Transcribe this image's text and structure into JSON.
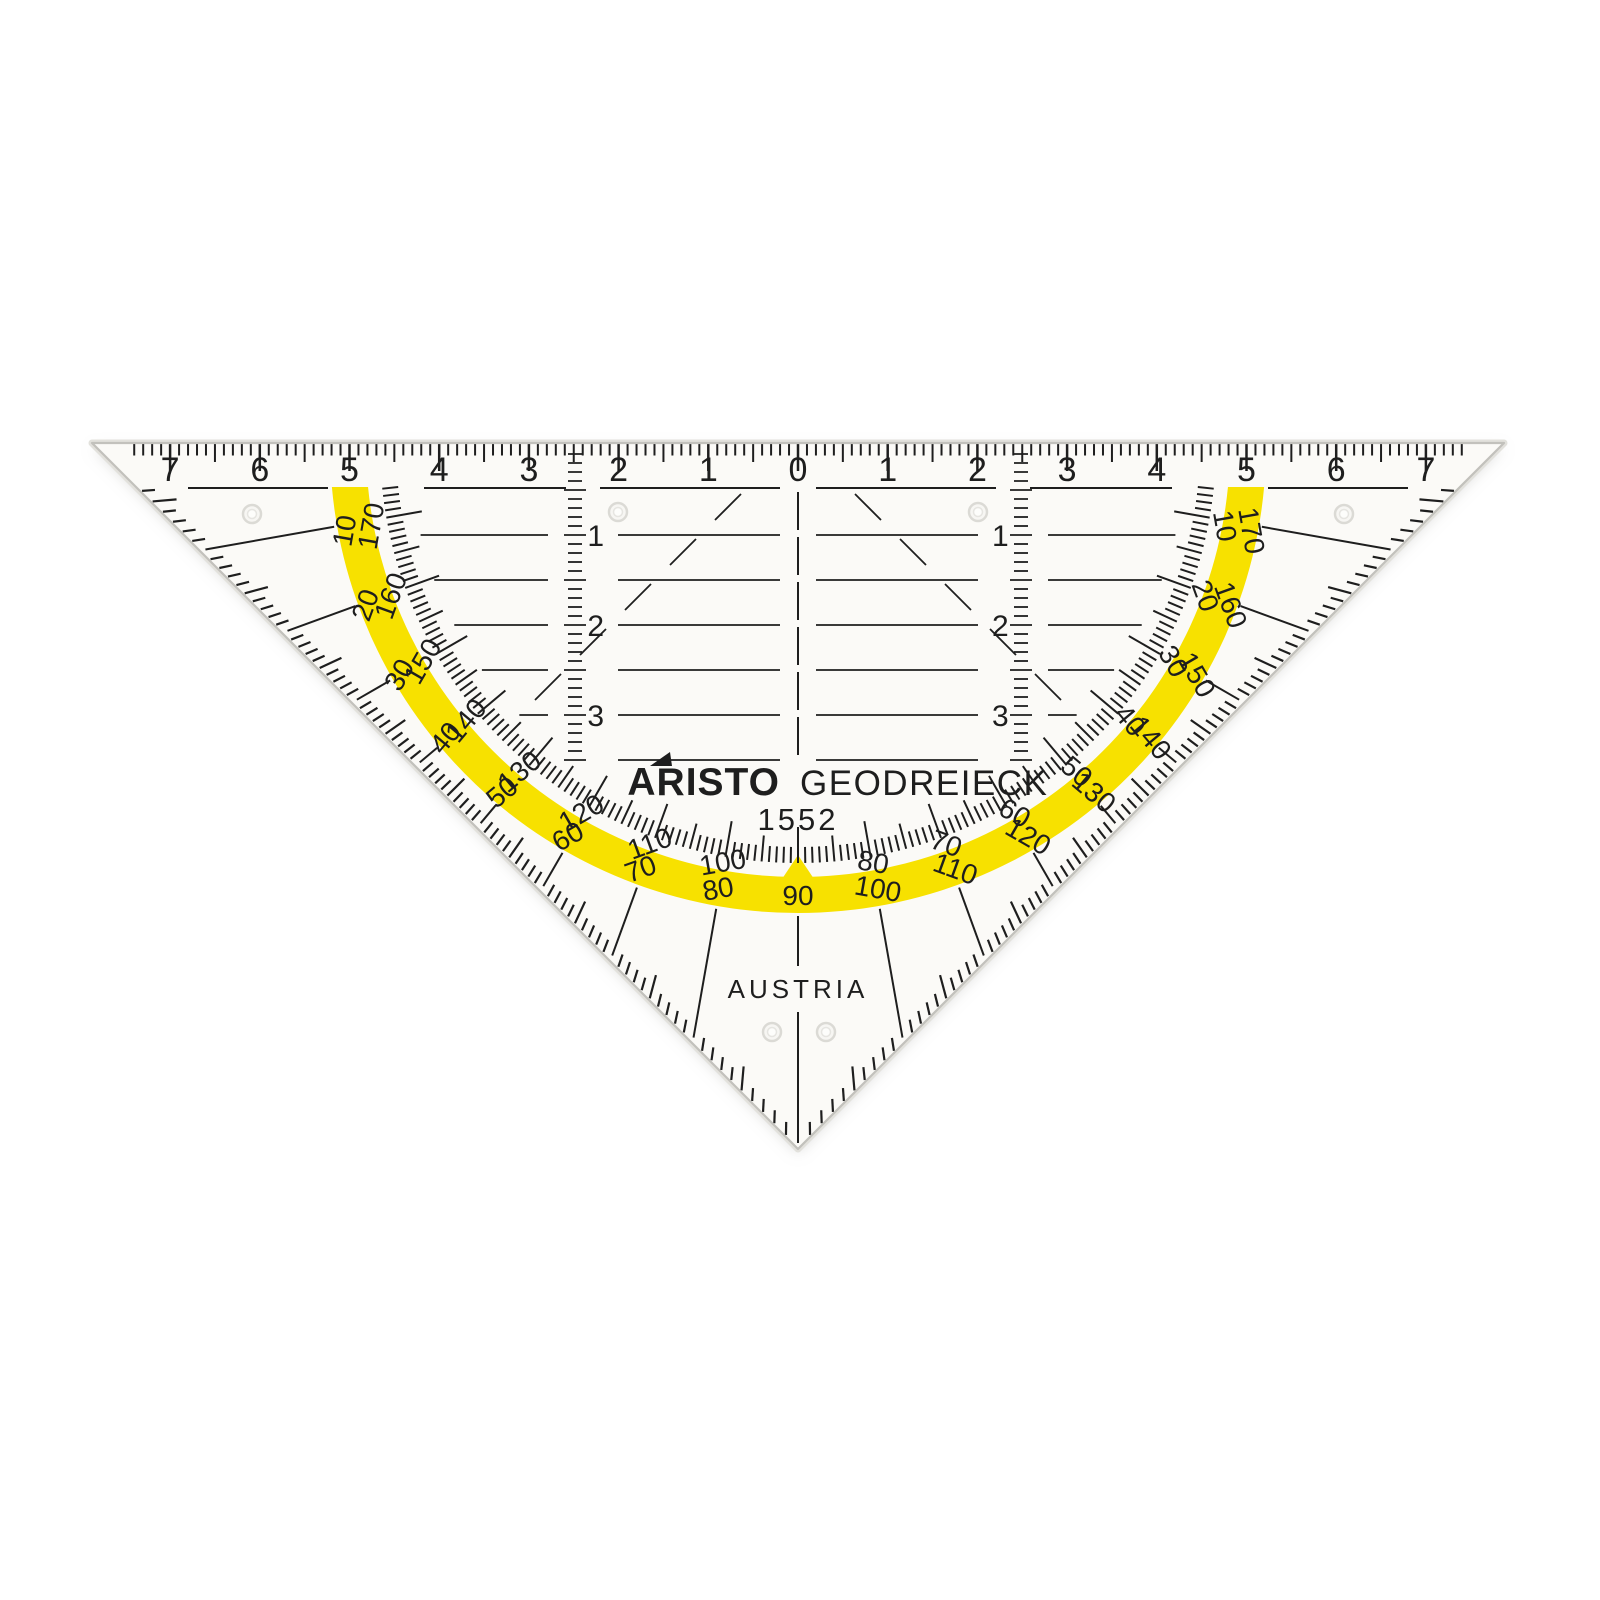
{
  "product": {
    "brand": "ARISTO",
    "name": "GEODREIECK",
    "model": "1552",
    "origin": "AUSTRIA"
  },
  "ruler": {
    "left_labels": [
      "7",
      "6",
      "5",
      "4",
      "3",
      "2",
      "1"
    ],
    "zero_label": "0",
    "right_labels": [
      "1",
      "2",
      "3",
      "4",
      "5",
      "6",
      "7"
    ]
  },
  "parallel_guides": {
    "labels": [
      "1",
      "2",
      "3"
    ]
  },
  "protractor": {
    "band_scale_deg": [
      "10",
      "20",
      "30",
      "40",
      "50",
      "60",
      "70",
      "80",
      "90",
      "100",
      "110",
      "120",
      "130",
      "140",
      "150",
      "160",
      "170"
    ],
    "inner_scale_deg": [
      "170",
      "160",
      "150",
      "140",
      "130",
      "120",
      "110",
      "100",
      "80",
      "70",
      "60",
      "50",
      "40",
      "30",
      "20",
      "10"
    ]
  },
  "colors": {
    "band_yellow": "#F7E100",
    "ink": "#1E1E1E",
    "body": "#FBFAF7",
    "body_edge": "#C2C1BC",
    "bevel": "#E2E1DC",
    "hole_ring": "#DBDAD5",
    "background": "#FFFFFF"
  }
}
